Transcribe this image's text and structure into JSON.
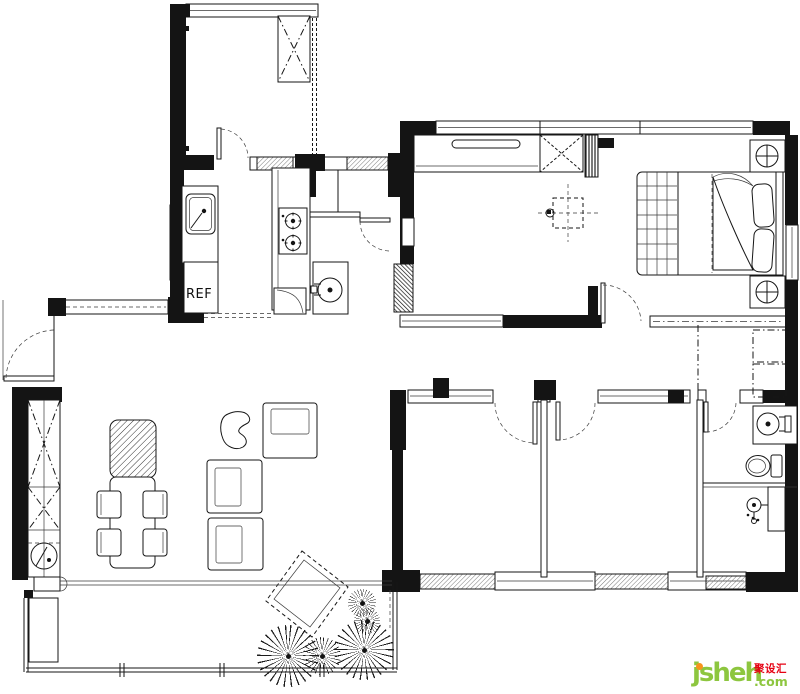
{
  "plan": {
    "labels": {
      "refrigerator": "REF"
    }
  },
  "watermark": {
    "brand": "jsheh",
    "tld": ".com",
    "cn_badge": "聚设汇"
  },
  "colors": {
    "line": "#161616",
    "background": "#ffffff",
    "brand_green": "#8dc63f",
    "brand_orange": "#f7941d",
    "brand_red": "#e60012"
  }
}
